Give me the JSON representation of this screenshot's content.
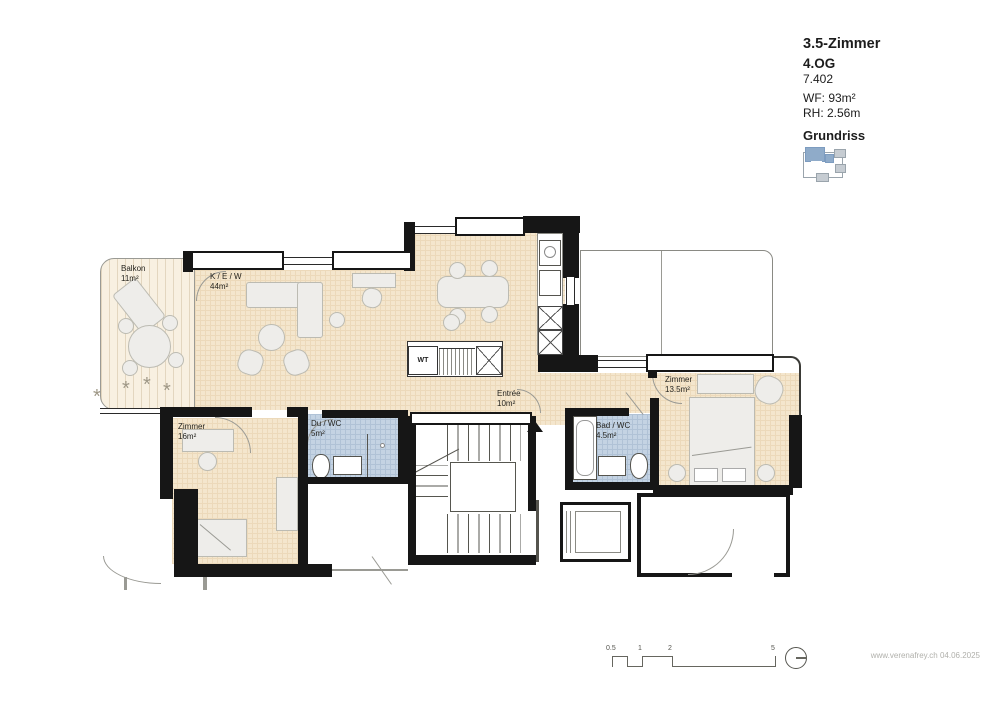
{
  "title_block": {
    "title": "3.5-Zimmer",
    "floor": "4.OG",
    "unit": "7.402",
    "living_area": "WF: 93m²",
    "room_height": "RH: 2.56m",
    "plan_label": "Grundriss"
  },
  "rooms": {
    "balkon": {
      "name": "Balkon",
      "area": "11m²"
    },
    "kitchen_living": {
      "name": "K / E / W",
      "area": "44m²"
    },
    "entree": {
      "name": "Entrée",
      "area": "10m²"
    },
    "bedroom_large": {
      "name": "Zimmer",
      "area": "16m²"
    },
    "bedroom_small": {
      "name": "Zimmer",
      "area": "13.5m²"
    },
    "shower_wc": {
      "name": "Du / WC",
      "area": "5m²"
    },
    "bath_wc": {
      "name": "Bad / WC",
      "area": "4.5m²"
    },
    "washer_tower": {
      "label": "WT"
    }
  },
  "scale_bar": {
    "labels": [
      "0.5",
      "1",
      "2",
      "5"
    ]
  },
  "footer": {
    "credit": "www.verenafrey.ch 04.06.2025"
  },
  "colors": {
    "floor_fill": "#f4e6cd",
    "wet_room_fill": "#c4d3e3",
    "wall": "#161616",
    "keyplan_highlight": "#8fabc9"
  }
}
